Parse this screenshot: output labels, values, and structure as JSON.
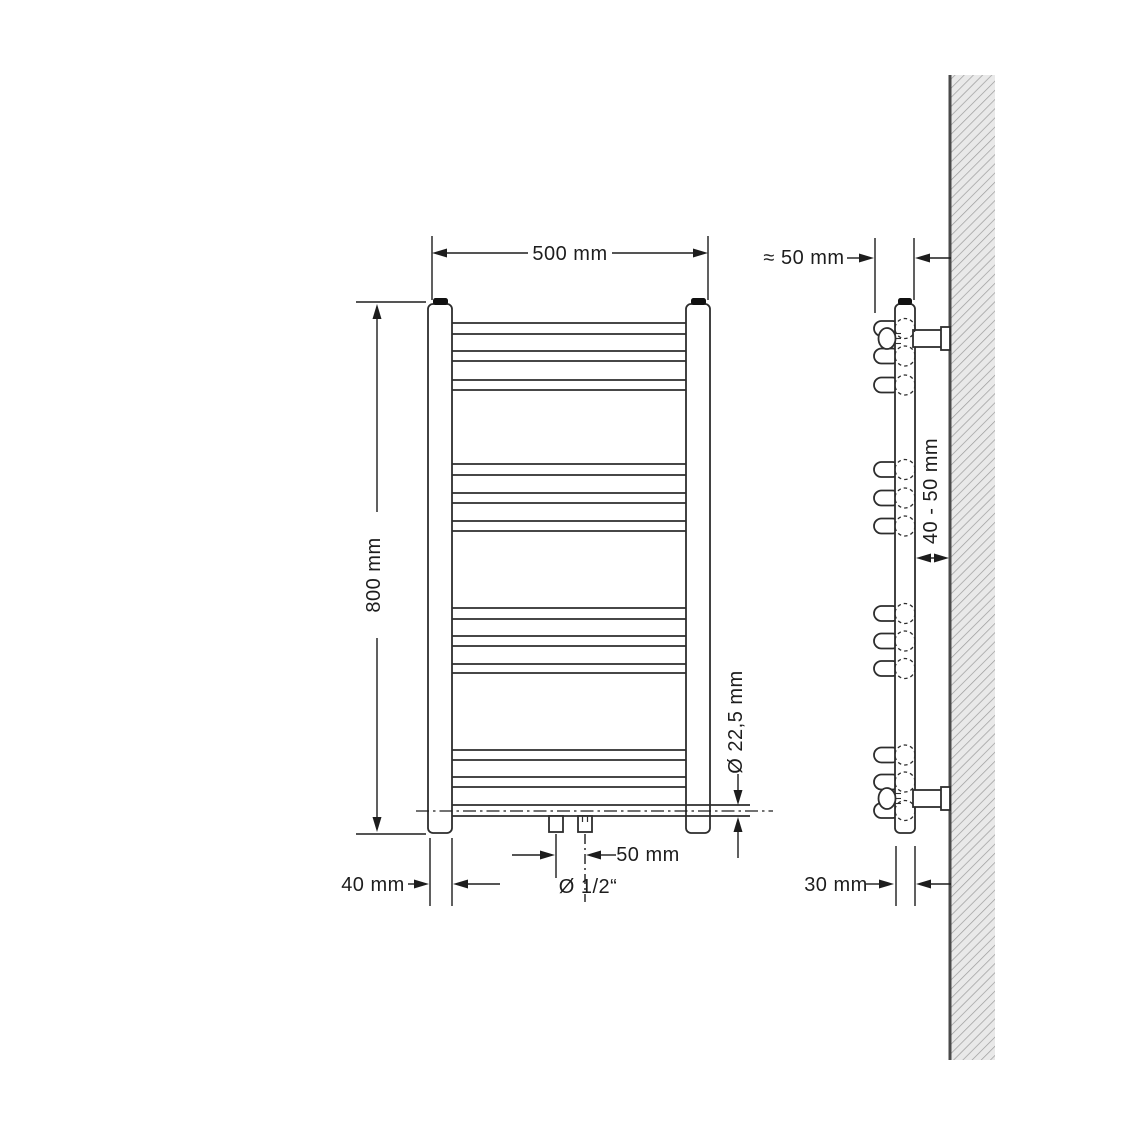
{
  "drawing": {
    "line_color": "#2d2d2d",
    "wall_fill": "#e9e9e9",
    "wall_hatch_color": "#9b9b9b",
    "front_view": {
      "width_label": "500 mm",
      "height_label": "800 mm",
      "column_width_label": "40 mm",
      "connection_spacing_label": "50 mm",
      "connection_thread_label": "Ø 1/2“",
      "tube_diameter_label": "Ø 22,5 mm"
    },
    "side_view": {
      "wall_clearance_label": "≈ 50 mm",
      "mount_distance_label": "40 - 50 mm",
      "depth_label": "30 mm"
    }
  }
}
